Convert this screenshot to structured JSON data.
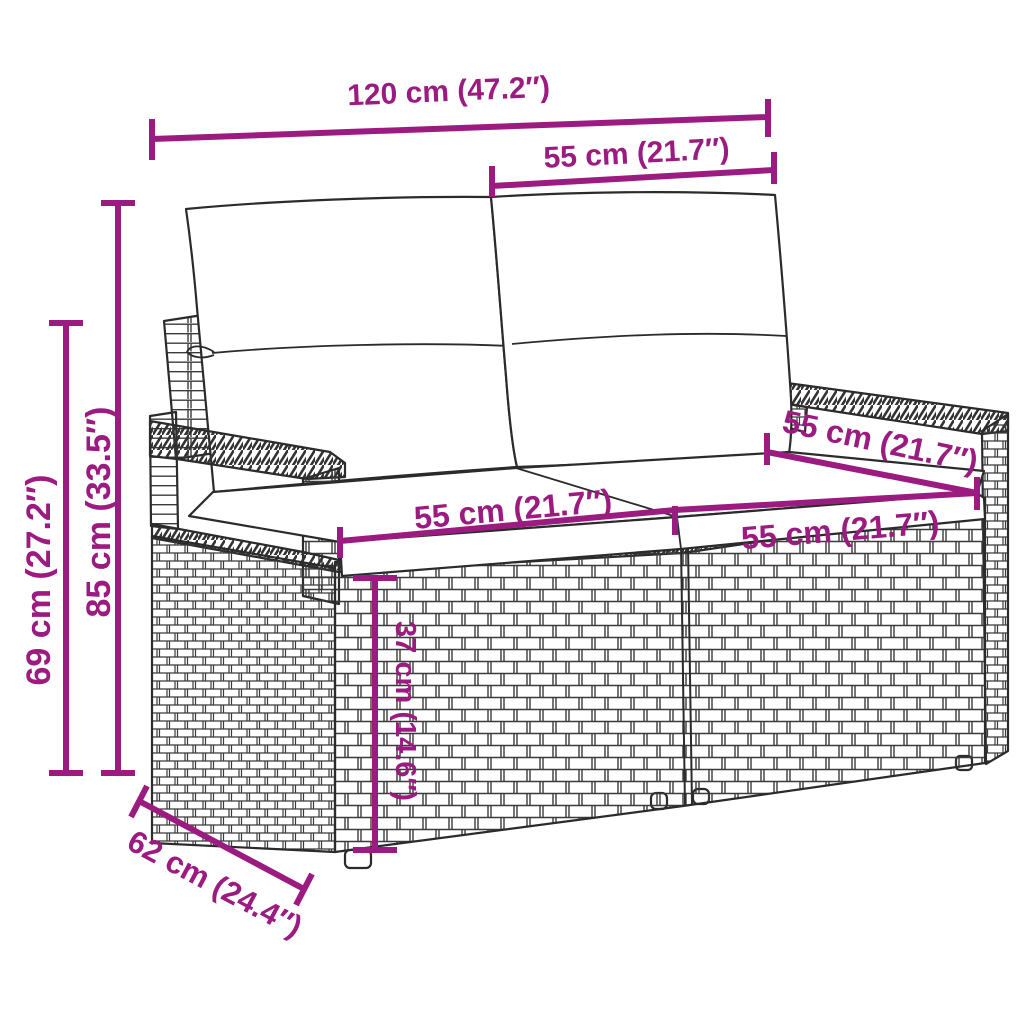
{
  "figure": {
    "subject": "two-seater poly rattan garden sofa with back and seat cushions",
    "style": "technical line drawing with dimension annotations"
  },
  "colors": {
    "dimension": "#9B1B80",
    "line_art": "#2B2B2B",
    "background": "#FFFFFF"
  },
  "dimensions": {
    "width_overall": {
      "label": "120 cm (47.2″)"
    },
    "width_backrest_section": {
      "label": "55 cm (21.7″)"
    },
    "height_overall": {
      "label": "85 cm (33.5″)"
    },
    "height_armrest": {
      "label": "69 cm (27.2″)"
    },
    "seat_width_left": {
      "label": "55 cm (21.7″)"
    },
    "seat_width_right": {
      "label": "55 cm (21.7″)"
    },
    "seat_depth_arm": {
      "label": "55 cm (21.7″)"
    },
    "height_base": {
      "label": "37 cm (14.6″)"
    },
    "depth_base": {
      "label": "62 cm (24.4″)"
    }
  }
}
